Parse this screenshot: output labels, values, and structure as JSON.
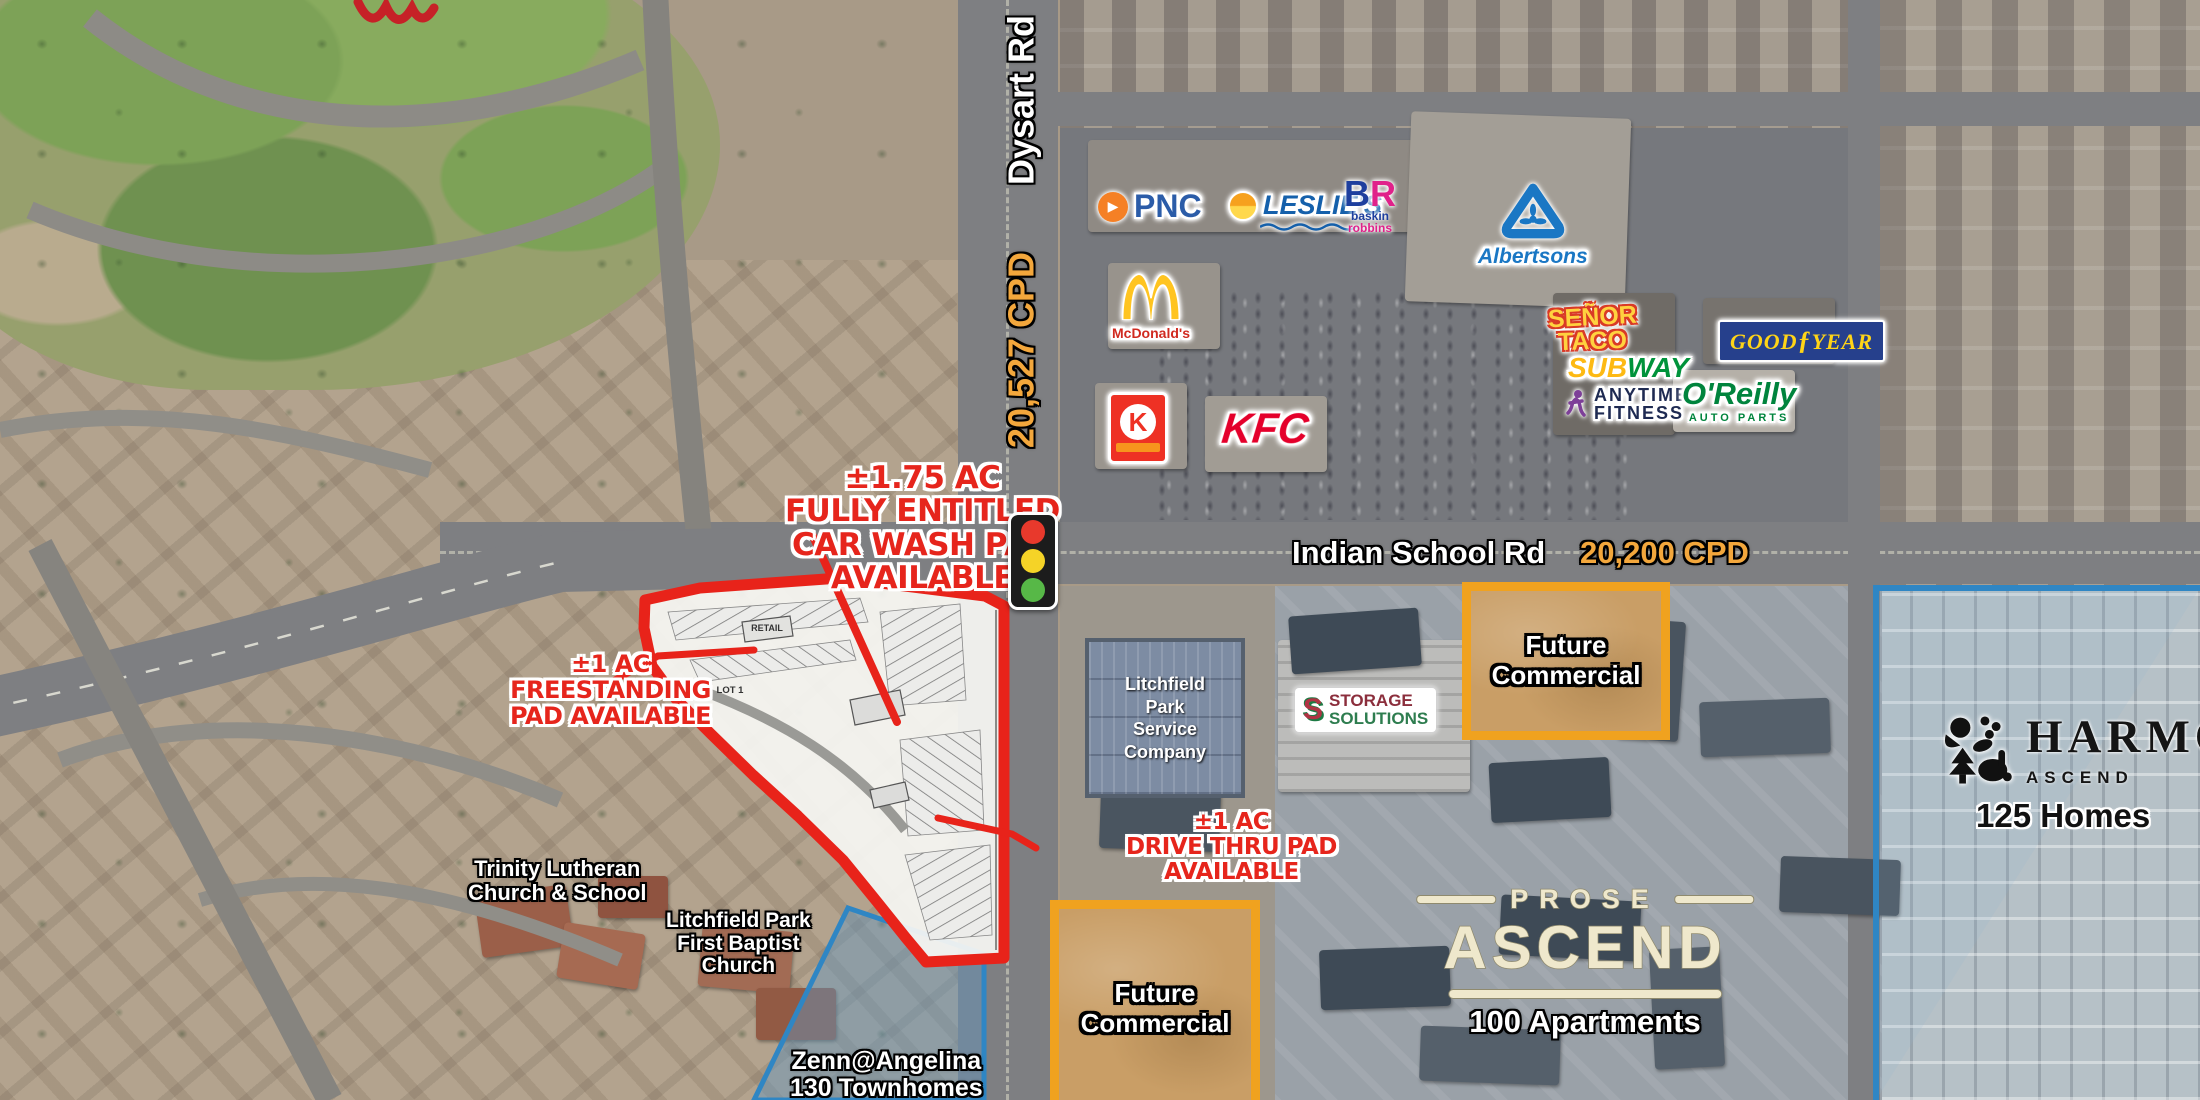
{
  "roads": {
    "dysart": {
      "label": "Dysart Rd",
      "cpd": "20,527 CPD"
    },
    "indian_school": {
      "label": "Indian School Rd",
      "cpd": "20,200 CPD"
    }
  },
  "annotations": {
    "car_wash": {
      "l1": "±1.75 AC",
      "l2": "FULLY ENTITLED",
      "l3": "CAR WASH PAD",
      "l4": "AVAILABLE"
    },
    "freestanding": {
      "l1": "±1 AC",
      "l2": "FREESTANDING",
      "l3": "PAD AVAILABLE"
    },
    "drive_thru": {
      "l1": "±1 AC",
      "l2": "DRIVE THRU PAD",
      "l3": "AVAILABLE"
    }
  },
  "site_plan": {
    "retail": "RETAIL",
    "lot1": "LOT 1"
  },
  "places": {
    "trinity": {
      "l1": "Trinity Lutheran",
      "l2": "Church & School"
    },
    "first_baptist": {
      "l1": "Litchfield Park",
      "l2": "First Baptist",
      "l3": "Church"
    },
    "zenn": {
      "l1": "Zenn@Angelina",
      "l2": "130 Townhomes"
    },
    "service_company": {
      "l1": "Litchfield",
      "l2": "Park",
      "l3": "Service",
      "l4": "Company"
    },
    "future_commercial_north": {
      "l1": "Future",
      "l2": "Commercial"
    },
    "future_commercial_south": {
      "l1": "Future",
      "l2": "Commercial"
    },
    "prose_ascend": {
      "brand": "PROSE",
      "name": "ASCEND",
      "units": "100 Apartments"
    },
    "harmony": {
      "name": "HARMONY",
      "sub": "ASCEND",
      "units": "125 Homes"
    }
  },
  "retailers": {
    "pnc": {
      "name": "PNC"
    },
    "mcdonalds": {
      "name": "McDonald's"
    },
    "leslies": {
      "name": "LESLIE'S"
    },
    "baskin": {
      "b": "B",
      "r": "R",
      "l1": "baskin",
      "l2": "robbins"
    },
    "albertsons": {
      "name": "Albertsons"
    },
    "circle_k": {
      "letter": "K"
    },
    "kfc": {
      "name": "KFC"
    },
    "senor_taco": {
      "l1": "SEÑOR",
      "l2": "TACO"
    },
    "subway": {
      "sub": "SUB",
      "way": "WAY"
    },
    "anytime": {
      "l1": "ANYTIME",
      "l2": "FITNESS"
    },
    "goodyear": {
      "good": "GOOD",
      "wing": "ƒ",
      "year": "YEAR"
    },
    "oreilly": {
      "name": "O'Reilly",
      "sub": "AUTO PARTS"
    },
    "storage": {
      "icon": "S",
      "l1": "STORAGE",
      "l2": "SOLUTIONS"
    }
  },
  "colors": {
    "annotation_red": "#E6251C",
    "traffic_count_gold": "#F3A73C",
    "parcel_blue": "#2F86C4",
    "future_commercial_orange": "#F0A21F",
    "site_outline_red": "#E8231A"
  }
}
